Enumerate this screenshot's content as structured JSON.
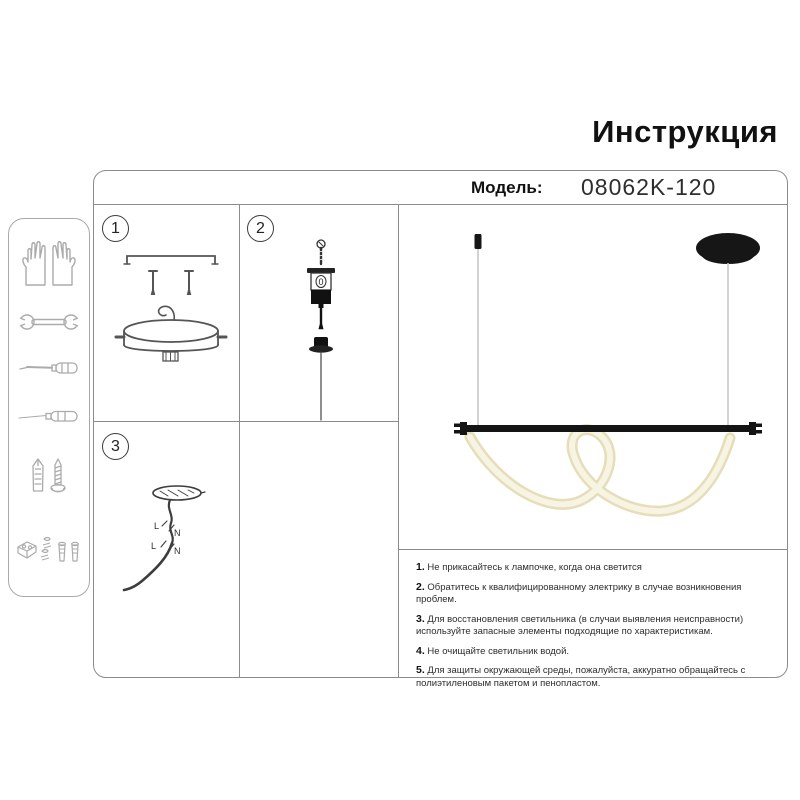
{
  "page": {
    "title": "Инструкция"
  },
  "model": {
    "label": "Модель:",
    "number": "08062K-120"
  },
  "panels": {
    "p1": "1",
    "p2": "2",
    "p3": "3"
  },
  "part2_marking": "0",
  "wiring_labels": {
    "l1": "L",
    "n1": "N",
    "l2": "L",
    "n2": "N"
  },
  "warnings": {
    "items": [
      {
        "num": "1.",
        "text": "Не прикасайтесь к лампочке, когда она светится"
      },
      {
        "num": "2.",
        "text": "Обратитесь к квалифицированному электрику в случае возникновения проблем."
      },
      {
        "num": "3.",
        "text": "Для восстановления светильника (в случаи выявления неисправности) используйте запасные элементы подходящие по характеристикам."
      },
      {
        "num": "4.",
        "text": "Не очищайте светильник водой."
      },
      {
        "num": "5.",
        "text": "Для защиты окружающей среды, пожалуйста, аккуратно обращайтесь с полиэтиленовым пакетом и пенопластом."
      }
    ]
  },
  "sidebar": {
    "icons": [
      "gloves-icon",
      "wrench-icon",
      "screwdriver-icon",
      "awl-icon",
      "anchor-screw-icon",
      "mounting-hardware-icon"
    ]
  },
  "colors": {
    "border_gray": "#8c8c8c",
    "icon_stroke": "#ababab",
    "diagram_stroke": "#555555",
    "lamp_black": "#161616",
    "led_tube": "#ece3c2",
    "led_tube_highlight": "#f8f4e3",
    "cable_gray": "#c6c6c6"
  }
}
